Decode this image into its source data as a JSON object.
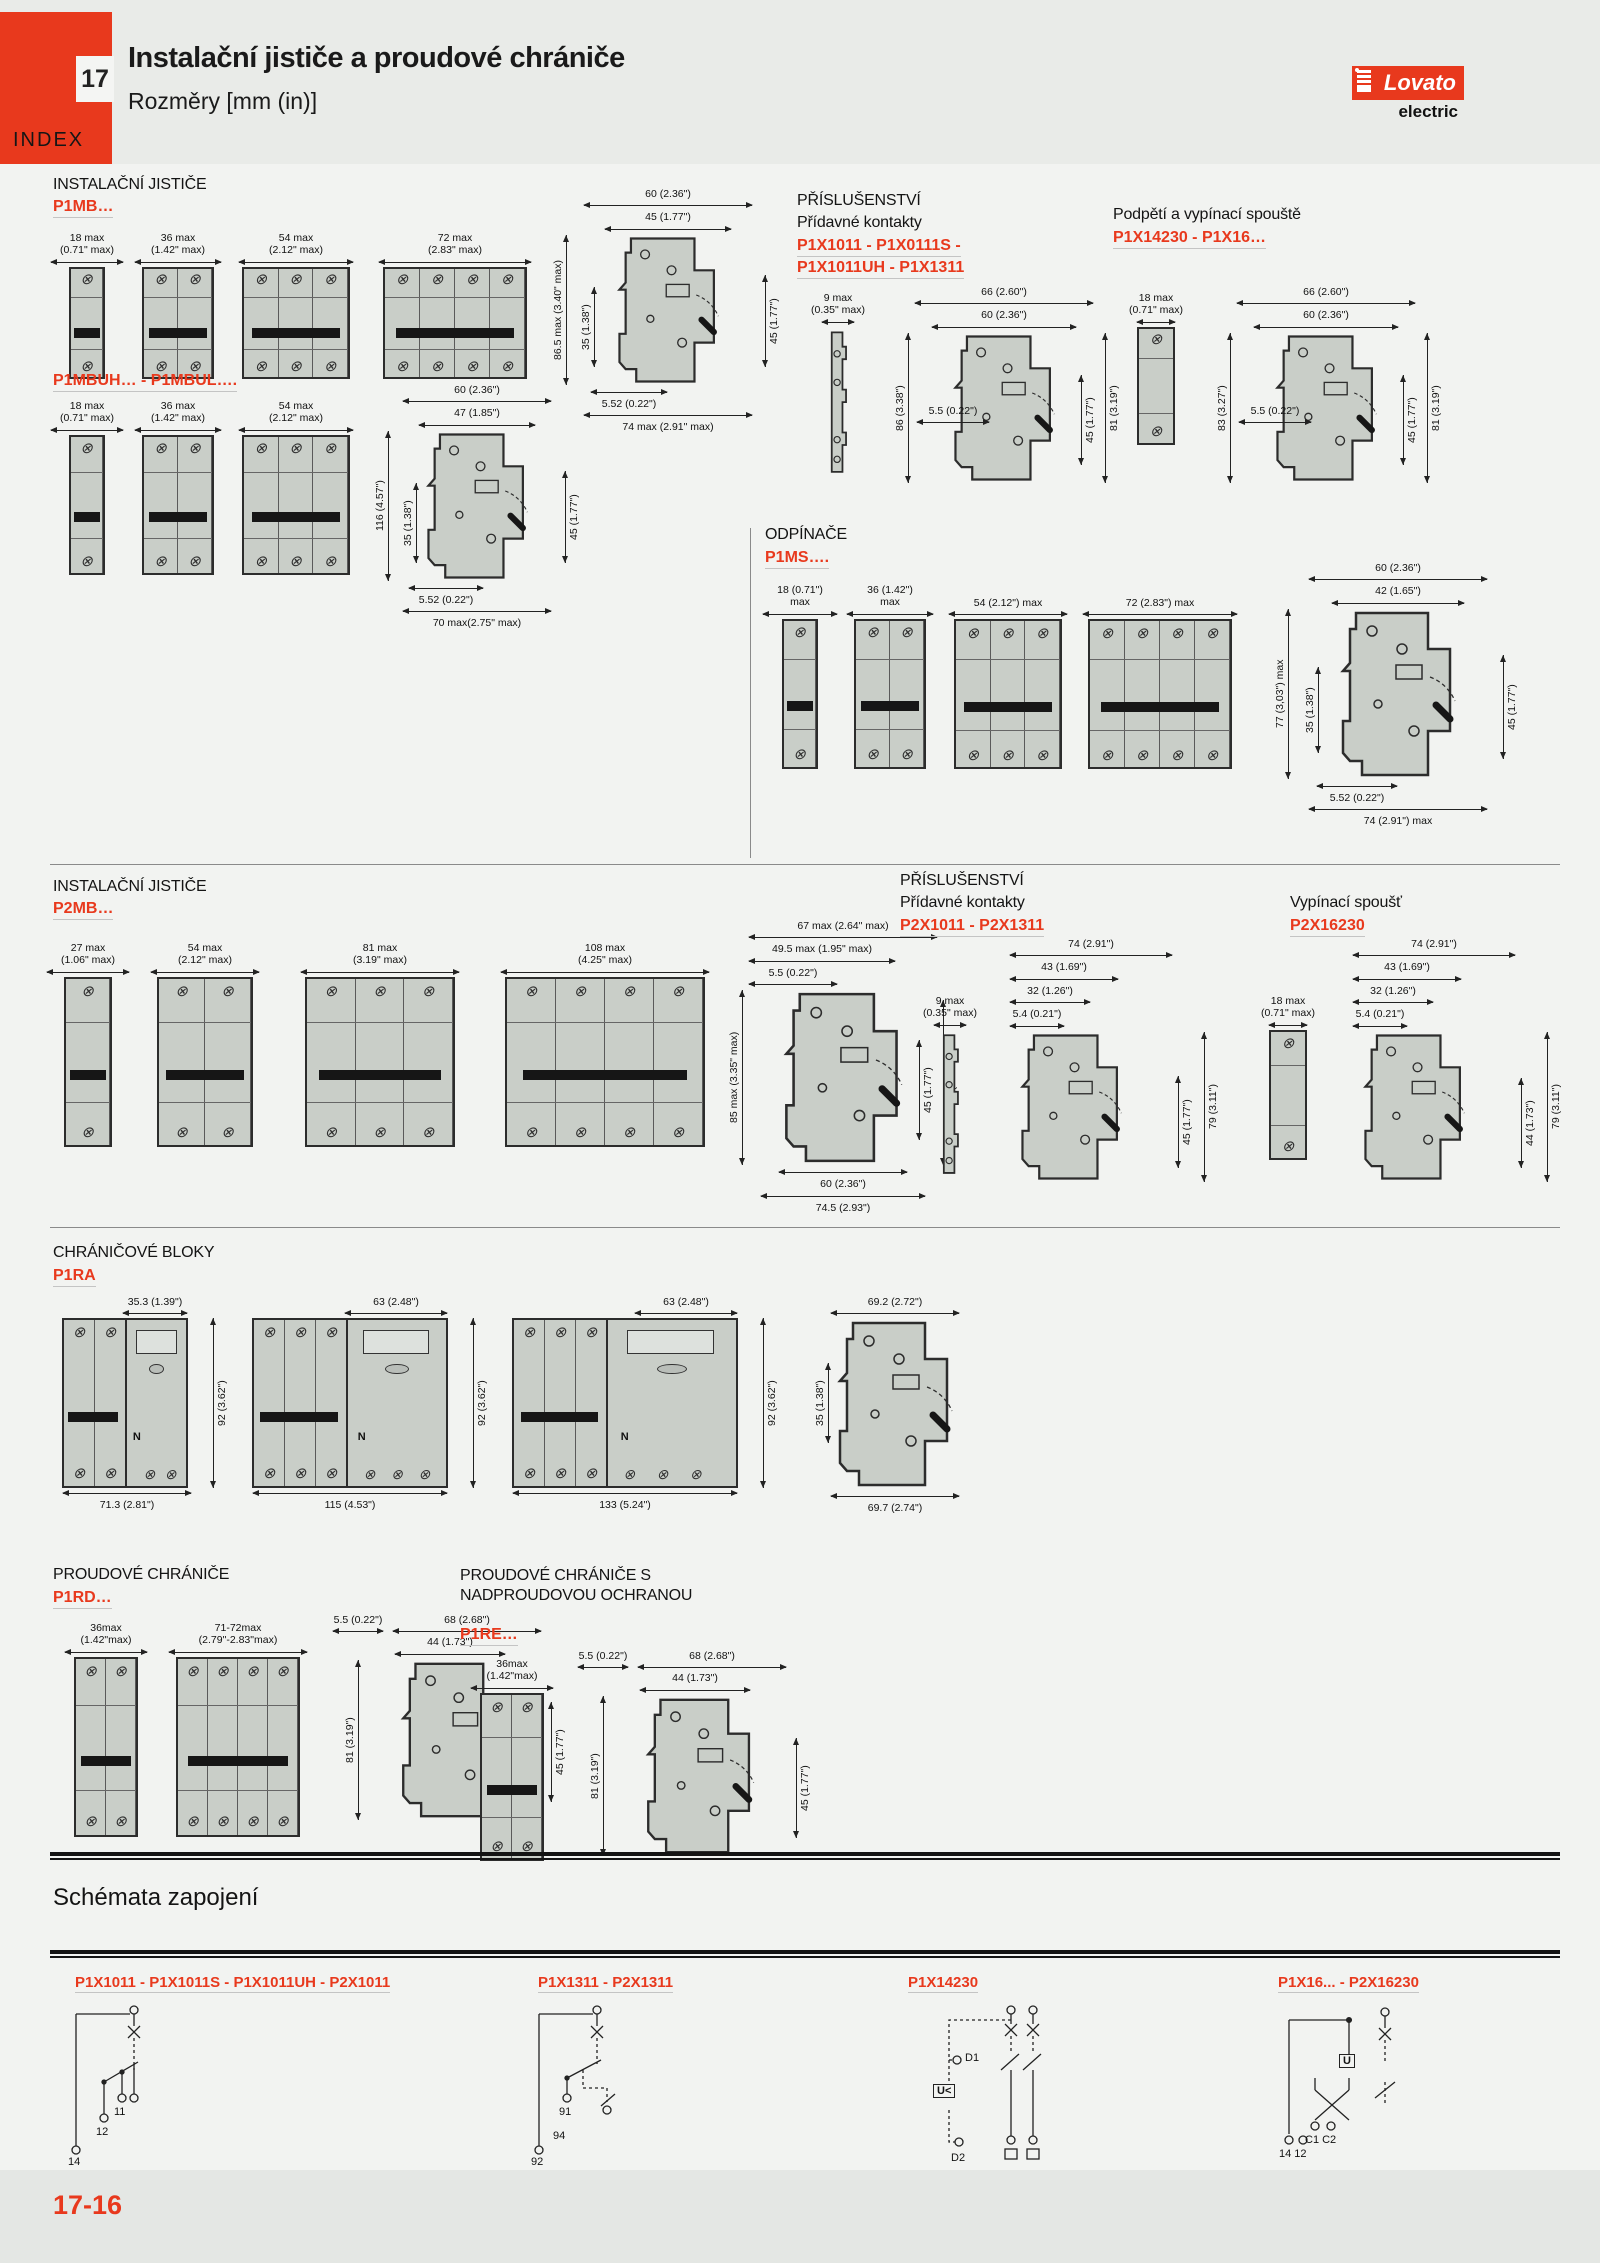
{
  "header": {
    "chapter": "17",
    "index": "INDEX",
    "title": "Instalační jističe a proudové chrániče",
    "subtitle": "Rozměry [mm (in)]",
    "logo_main": "Lovato",
    "logo_sub": "electric"
  },
  "s1": {
    "heading": "INSTALAČNÍ JISTIČE",
    "code": "P1MB…",
    "fronts": [
      {
        "mm": "18 max",
        "in": "(0.71\" max)"
      },
      {
        "mm": "36 max",
        "in": "(1.42\" max)"
      },
      {
        "mm": "54 max",
        "in": "(2.12\" max)"
      },
      {
        "mm": "72 max",
        "in": "(2.83\" max)"
      }
    ],
    "side": {
      "top1": "60 (2.36\")",
      "top2": "45 (1.77\")",
      "left1": "86.5 max (3.40\" max)",
      "left2": "35 (1.38\")",
      "right1": "45 (1.77\")",
      "bot1": "5.52 (0.22\")",
      "bot2": "74 max (2.91\" max)"
    }
  },
  "s2": {
    "heading": "PŘÍSLUŠENSTVÍ",
    "sub": "Přídavné kontakty",
    "code1": "P1X1011 - P1X0111S -",
    "code2": "P1X1011UH - P1X1311",
    "aux_mm": "9 max",
    "aux_in": "(0.35\" max)",
    "side": {
      "top1": "66 (2.60\")",
      "top2": "60 (2.36\")",
      "left1": "86 (3.38\")",
      "mid1": "5.5 (0.22\")",
      "right1": "45 (1.77\")",
      "right2": "81 (3.19\")"
    }
  },
  "s3": {
    "heading": "Podpětí a vypínací spouště",
    "code": "P1X14230 - P1X16…",
    "front_mm": "18 max",
    "front_in": "(0.71\" max)",
    "side": {
      "top1": "66 (2.60\")",
      "top2": "60 (2.36\")",
      "left1": "83 (3.27\")",
      "mid1": "5.5 (0.22\")",
      "right1": "45 (1.77\")",
      "right2": "81 (3.19\")"
    }
  },
  "s4": {
    "code": "P1MBUH… - P1MBUL….",
    "fronts": [
      {
        "mm": "18 max",
        "in": "(0.71\" max)"
      },
      {
        "mm": "36 max",
        "in": "(1.42\" max)"
      },
      {
        "mm": "54 max",
        "in": "(2.12\" max)"
      }
    ],
    "side": {
      "top1": "60 (2.36\")",
      "top2": "47 (1.85\")",
      "left1": "116 (4.57\")",
      "left2": "35 (1.38\")",
      "right1": "45 (1.77\")",
      "bot1": "5.52 (0.22\")",
      "bot2": "70 max(2.75\" max)"
    }
  },
  "s5": {
    "heading": "ODPÍNAČE",
    "code": "P1MS….",
    "fronts": [
      {
        "mm": "18 (0.71\")",
        "in": "max"
      },
      {
        "mm": "36 (1.42\")",
        "in": "max"
      },
      {
        "mm": "54 (2.12\") max",
        "in": ""
      },
      {
        "mm": "72 (2.83\") max",
        "in": ""
      }
    ],
    "side": {
      "top1": "60 (2.36\")",
      "top2": "42 (1.65\")",
      "left1": "77 (3,03\") max",
      "left2": "35 (1.38\")",
      "right1": "45 (1.77\")",
      "bot1": "5.52 (0.22\")",
      "bot2": "74 (2.91\") max"
    }
  },
  "s6": {
    "heading": "INSTALAČNÍ JISTIČE",
    "code": "P2MB…",
    "fronts": [
      {
        "mm": "27 max",
        "in": "(1.06\" max)"
      },
      {
        "mm": "54 max",
        "in": "(2.12\" max)"
      },
      {
        "mm": "81 max",
        "in": "(3.19\" max)"
      },
      {
        "mm": "108 max",
        "in": "(4.25\" max)"
      }
    ],
    "side": {
      "top1": "67 max (2.64\" max)",
      "top2": "49.5 max (1.95\" max)",
      "top3": "5.5 (0.22\")",
      "left1": "85 max (3.35\" max)",
      "right1": "45 (1.77\")",
      "right2": "80 (3.15\")",
      "bot1": "60 (2.36\")",
      "bot2": "74.5 (2.93\")"
    }
  },
  "s7": {
    "heading": "PŘÍSLUŠENSTVÍ",
    "sub": "Přídavné kontakty",
    "code": "P2X1011 - P2X1311",
    "aux_mm": "9 max",
    "aux_in": "(0.35\" max)",
    "side": {
      "top1": "74 (2.91\")",
      "top2": "43 (1.69\")",
      "top3": "32 (1.26\")",
      "top4": "5.4 (0.21\")",
      "right1": "45 (1.77\")",
      "right2": "79 (3.11\")"
    }
  },
  "s8": {
    "heading": "Vypínací spoušť",
    "code": "P2X16230",
    "front_mm": "18 max",
    "front_in": "(0.71\" max)",
    "side": {
      "top1": "74 (2.91\")",
      "top2": "43 (1.69\")",
      "top3": "32 (1.26\")",
      "top4": "5.4 (0.21\")",
      "right1": "44 (1.73\")",
      "right2": "79 (3.11\")"
    }
  },
  "s9": {
    "heading": "CHRÁNIČOVÉ BLOKY",
    "code": "P1RA",
    "d1": {
      "top": "35.3 (1.39\")",
      "right": "92 (3.62\")",
      "bottom": "71.3 (2.81\")",
      "n": "N"
    },
    "d2": {
      "top": "63 (2.48\")",
      "right": "92 (3.62\")",
      "bottom": "115 (4.53\")",
      "n": "N"
    },
    "d3": {
      "top": "63 (2.48\")",
      "right": "92 (3.62\")",
      "bottom": "133 (5.24\")",
      "n": "N"
    },
    "d4": {
      "top": "69.2 (2.72\")",
      "left": "35 (1.38\")",
      "bottom": "69.7 (2.74\")"
    }
  },
  "s10": {
    "heading": "PROUDOVÉ CHRÁNIČE",
    "code": "P1RD…",
    "fronts": [
      {
        "mm": "36max",
        "in": "(1.42\"max)"
      },
      {
        "mm": "71-72max",
        "in": "(2.79\"-2.83\"max)"
      }
    ],
    "side": {
      "top1": "5.5 (0.22\")",
      "top2": "68 (2.68\")",
      "top3": "44 (1.73\")",
      "left1": "81 (3.19\")",
      "right1": "45 (1.77\")"
    }
  },
  "s11": {
    "heading": "PROUDOVÉ CHRÁNIČE S NADPROUDOVOU OCHRANOU",
    "code": "P1RE…",
    "front_mm": "36max",
    "front_in": "(1.42\"max)",
    "side": {
      "top1": "5.5 (0.22\")",
      "top2": "68 (2.68\")",
      "top3": "44 (1.73\")",
      "left1": "81 (3.19\")",
      "right1": "45 (1.77\")"
    }
  },
  "s12": {
    "title": "Schémata zapojení",
    "d1": {
      "label": "P1X1011 - P1X1011S - P1X1011UH - P2X1011",
      "t1": "11",
      "t2": "12",
      "t3": "14"
    },
    "d2": {
      "label": "P1X1311 - P2X1311",
      "t1": "91",
      "t2": "94",
      "t3": "92"
    },
    "d3": {
      "label": "P1X14230",
      "t1": "D1",
      "t2": "U<",
      "t3": "D2"
    },
    "d4": {
      "label": "P1X16... - P2X16230",
      "t1": "U",
      "t2": "C1 C2",
      "t3": "14 12"
    }
  },
  "footer": {
    "page": "17-16"
  }
}
